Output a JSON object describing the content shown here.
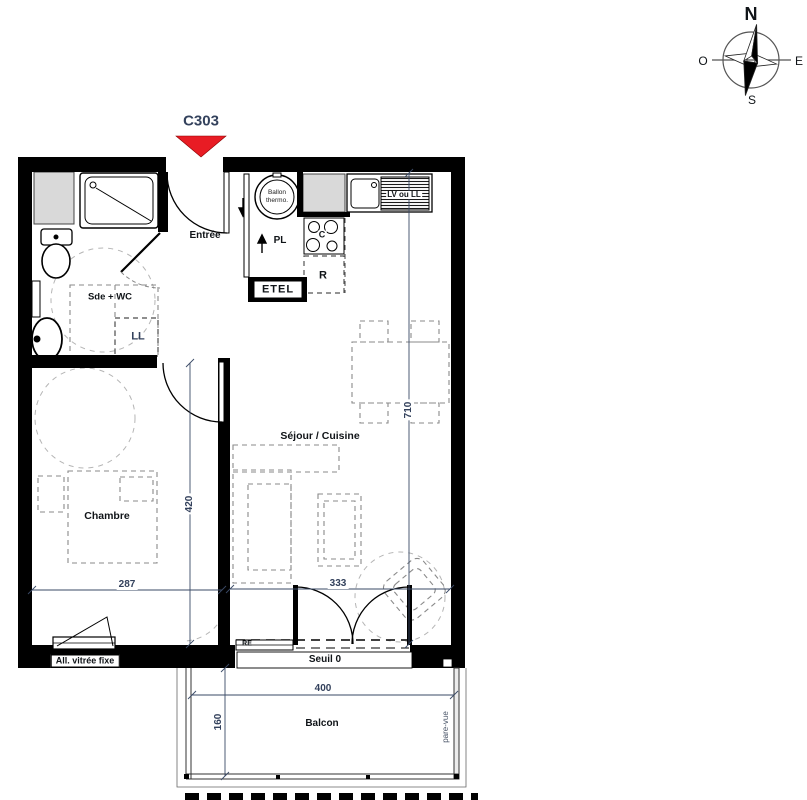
{
  "title_marker": {
    "unit": "C303"
  },
  "compass": {
    "north": "N",
    "west": "O",
    "east": "E",
    "south": "S"
  },
  "rooms": {
    "entree": "Entrée",
    "bathroom": "Sde + WC",
    "bedroom": "Chambre",
    "living": "Séjour / Cuisine",
    "balcony": "Balcon"
  },
  "fixtures": {
    "closet": "PL",
    "etel": "ETEL",
    "washer": "LL",
    "washer_dishwasher": "LV ou LL",
    "fridge": "R",
    "cooktop": "C",
    "water_heater_line1": "Ballon",
    "water_heater_line2": "thermo.",
    "glazing_tag": "RE"
  },
  "notes": {
    "fixed_glazing": "All. vitrée fixe",
    "threshold": "Seuil 0",
    "privacy_screen": "pare-vue"
  },
  "dimensions_cm": {
    "bedroom_width": "287",
    "bedroom_depth": "420",
    "living_width": "333",
    "apartment_depth": "710",
    "balcony_width": "400",
    "balcony_depth": "160"
  },
  "colors": {
    "wall": "#000000",
    "shaft": "#d9d9d9",
    "marker": "#e81c24",
    "dim_text": "#33415c"
  }
}
